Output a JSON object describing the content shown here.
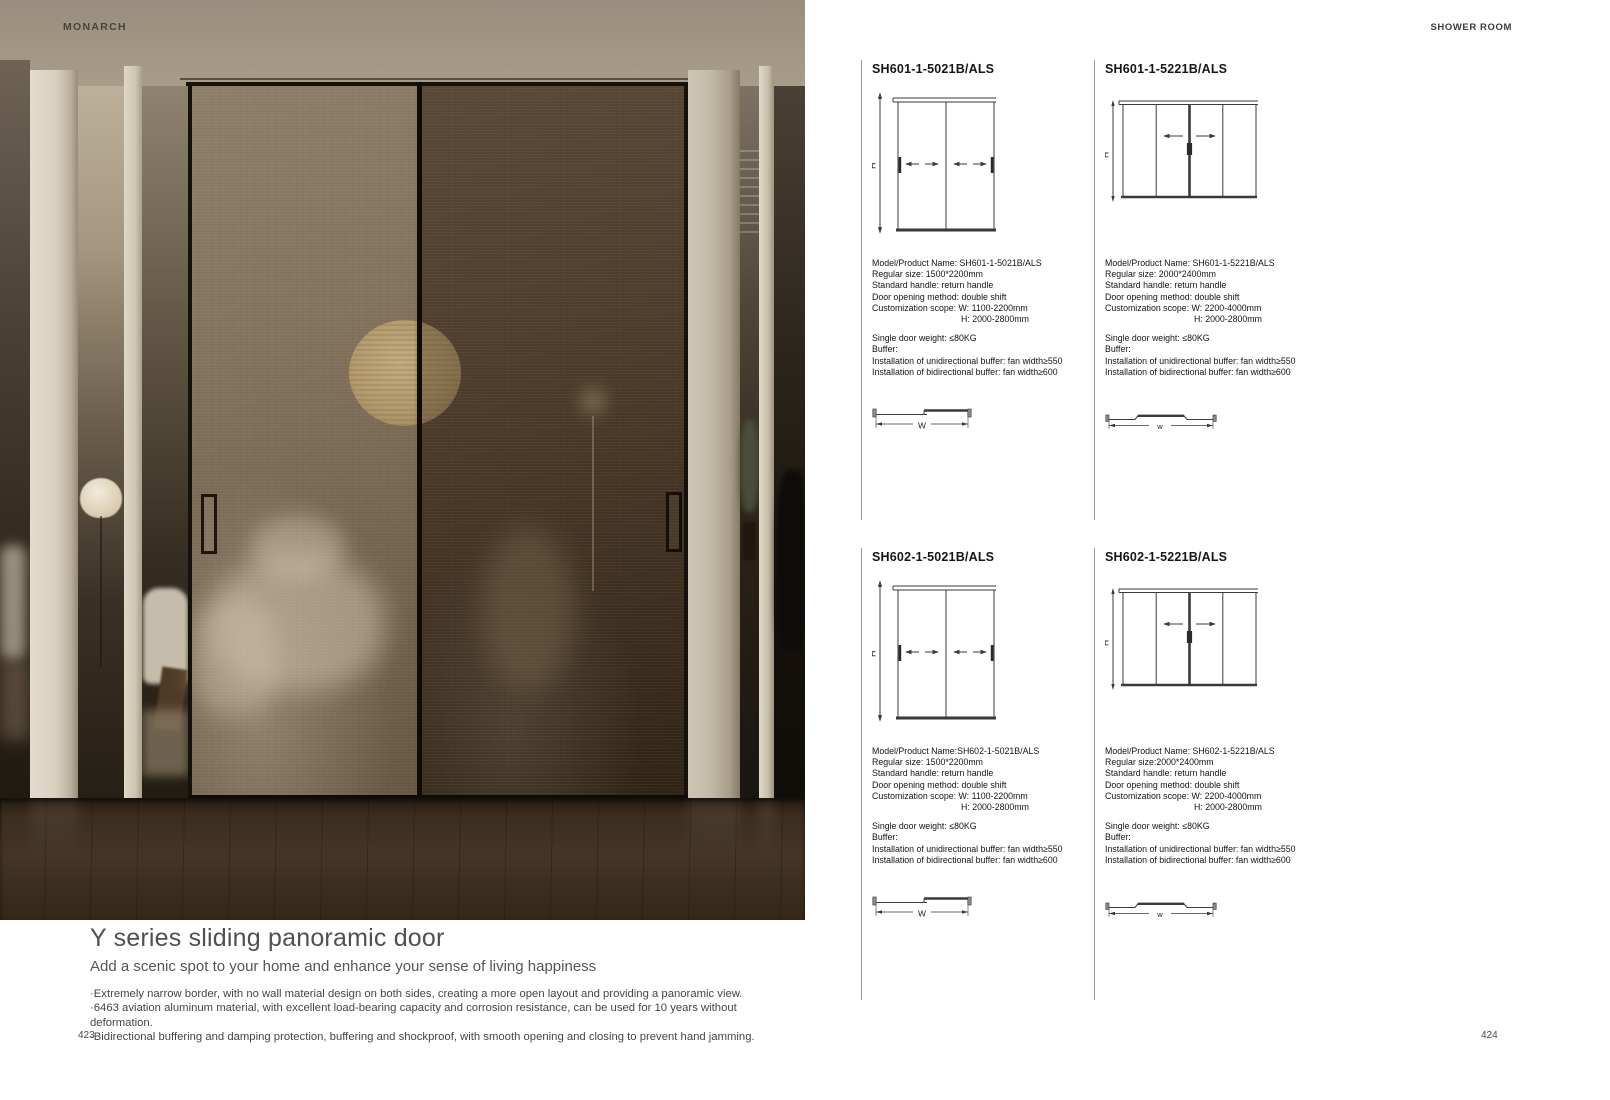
{
  "brand": "MONARCH",
  "section_header": "SHOWER ROOM",
  "colors": {
    "photo_wall": "#b2a694",
    "photo_column": "#d8d0bf",
    "door_glass_left": "#7e6d58",
    "door_glass_right": "#463626",
    "moon_lamp": "#b39a6c",
    "floor": "#3b2d1f",
    "diagram_ink": "#3a3a3a",
    "text": "#1f1f1f"
  },
  "left_page": {
    "page_number": "423",
    "title": "Y series sliding panoramic door",
    "subtitle": "Add a scenic spot to your home and enhance your sense of living happiness",
    "bullets": [
      "·Extremely narrow border, with no wall material design on both sides, creating a more open layout and providing a panoramic view.",
      "·6463 aviation aluminum material, with excellent load-bearing capacity and corrosion resistance, can be used for 10 years without deformation.",
      "·Bidirectional buffering and damping protection, buffering and shockproof, with smooth opening and closing to prevent hand jamming."
    ]
  },
  "right_page": {
    "page_number": "424",
    "products": [
      {
        "title": "SH601-1-5021B/ALS",
        "diagram_type": "two-panel-sliding-elevation",
        "h_label": "H",
        "w_label": "W",
        "specs": [
          "Model/Product Name: SH601-1-5021B/ALS",
          "Regular size: 1500*2200mm",
          "Standard handle: return handle",
          "Door opening method: double shift",
          "Customization scope: W: 1100-2200mm",
          "H: 2000-2800mm"
        ],
        "buffer": [
          "Single door weight: ≤80KG",
          "Buffer:",
          "Installation of unidirectional buffer: fan width≥550",
          "Installation of bidirectional buffer: fan width≥600"
        ]
      },
      {
        "title": "SH601-1-5221B/ALS",
        "diagram_type": "four-panel-sliding-elevation",
        "h_label": "H",
        "w_label": "w",
        "specs": [
          "Model/Product Name: SH601-1-5221B/ALS",
          "Regular size: 2000*2400mm",
          "Standard handle: return handle",
          "Door opening method: double shift",
          "Customization scope: W: 2200-4000mm",
          "H: 2000-2800mm"
        ],
        "buffer": [
          "Single door weight: ≤80KG",
          "Buffer:",
          "Installation of unidirectional buffer: fan width≥550",
          "Installation of bidirectional buffer: fan width≥600"
        ]
      },
      {
        "title": "SH602-1-5021B/ALS",
        "diagram_type": "two-panel-sliding-elevation",
        "h_label": "H",
        "w_label": "W",
        "specs": [
          "Model/Product Name:SH602-1-5021B/ALS",
          "Regular size: 1500*2200mm",
          "Standard handle: return handle",
          "Door opening method: double shift",
          "Customization scope: W: 1100-2200mm",
          "H: 2000-2800mm"
        ],
        "buffer": [
          "Single door weight: ≤80KG",
          "Buffer:",
          "Installation of unidirectional buffer: fan width≥550",
          "Installation of bidirectional buffer: fan width≥600"
        ]
      },
      {
        "title": "SH602-1-5221B/ALS",
        "diagram_type": "four-panel-sliding-elevation",
        "h_label": "H",
        "w_label": "w",
        "specs": [
          "Model/Product Name: SH602-1-5221B/ALS",
          "Regular size:2000*2400mm",
          "Standard handle: return handle",
          "Door opening method: double shift",
          "Customization scope: W: 2200-4000mm",
          "H: 2000-2800mm"
        ],
        "buffer": [
          "Single door weight: ≤80KG",
          "Buffer:",
          "Installation of unidirectional buffer: fan width≥550",
          "Installation of bidirectional buffer: fan width≥600"
        ]
      }
    ]
  }
}
